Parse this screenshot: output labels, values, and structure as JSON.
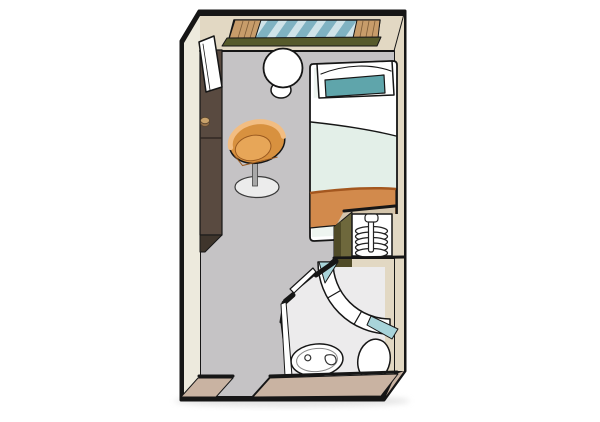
{
  "floorplan": {
    "kind": "cabin-floor-plan-illustration",
    "rooms": [
      "main-cabin",
      "bathroom"
    ],
    "fixtures": [
      "window",
      "curtains",
      "window-sill",
      "wardrobe",
      "leaning-door-panel",
      "round-table",
      "stool",
      "swivel-chair",
      "single-bed",
      "pillow",
      "accent-pillow",
      "duvet",
      "foot-blanket",
      "hanger-closet",
      "clothes-rail",
      "hangers",
      "shower",
      "shower-glass-panels",
      "washbasin",
      "toilet",
      "bathroom-door",
      "entrance-opening"
    ]
  },
  "colors": {
    "background": "#ffffff",
    "outline": "#161616",
    "shadow": "#d9d9d9",
    "wall_face_top": "#e2d8c3",
    "wall_face_left": "#edeadd",
    "wall_face_bottom": "#c9b3a2",
    "floor": "#c5c3c5",
    "bathroom_floor": "#ecebec",
    "window_glass": "#7fb2c2",
    "glass_stripe": "#cfe3e9",
    "curtain": "#c79c6a",
    "curtain_pleat": "#7d5c38",
    "sill": "#565a2b",
    "wardrobe": "#594a40",
    "wardrobe_front": "#3f352c",
    "knob": "#c9a26b",
    "knob_side": "#96714a",
    "panel_white": "#ffffff",
    "table": "#ffffff",
    "chair_body": "#d8913f",
    "chair_seat": "#e7a658",
    "chair_highlight": "#f2bd82",
    "chair_stem": "#a8a8a8",
    "chair_base": "#ececec",
    "bed_frame": "#ffffff",
    "mattress": "#eef5f0",
    "pillow": "#ffffff",
    "pillow_accent": "#5fa5ab",
    "sheet": "#ffffff",
    "duvet": "#e3efe8",
    "blanket": "#d28a4c",
    "blanket_edge": "#a4571f",
    "closet_olive": "#6e683c",
    "closet_olive_dark": "#4f4a27",
    "closet_top": "#d4c5ac",
    "shower_glass": "#ffffff",
    "shower_teal": "#a8d4da",
    "fixture_white": "#ffffff"
  }
}
